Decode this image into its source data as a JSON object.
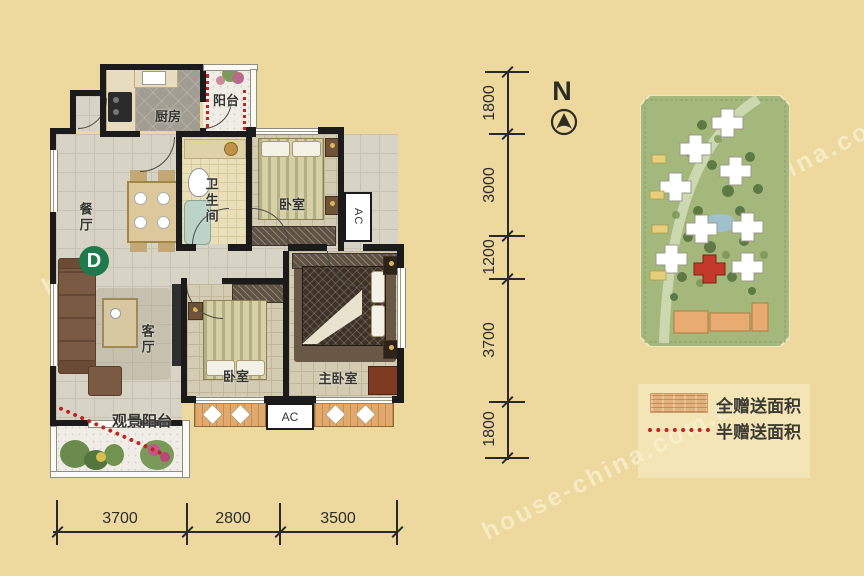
{
  "watermark": "house-china.com.cn",
  "compass": {
    "label": "N"
  },
  "unit_badge": "D",
  "rooms": {
    "balcony_top": "阳台",
    "kitchen": "厨房",
    "dining": "餐厅",
    "bathroom": "卫生间",
    "bedroom1": "卧室",
    "living": "客厅",
    "bedroom2": "卧室",
    "master": "主卧室",
    "view_balcony": "观景阳台",
    "ac_right": "AC",
    "ac_bottom": "AC"
  },
  "dimensions": {
    "bottom": [
      "3700",
      "2800",
      "3500"
    ],
    "right": [
      "1800",
      "3000",
      "1200",
      "3700",
      "1800"
    ]
  },
  "legend": {
    "full_gift": "全赠送面积",
    "half_gift": "半赠送面积"
  },
  "colors": {
    "background": "#edd89d",
    "wall": "#1b1b1b",
    "gift_dot_red": "#c32222",
    "badge_green": "#1e7a4b",
    "gift_strip_orange": "#e2a96d"
  }
}
